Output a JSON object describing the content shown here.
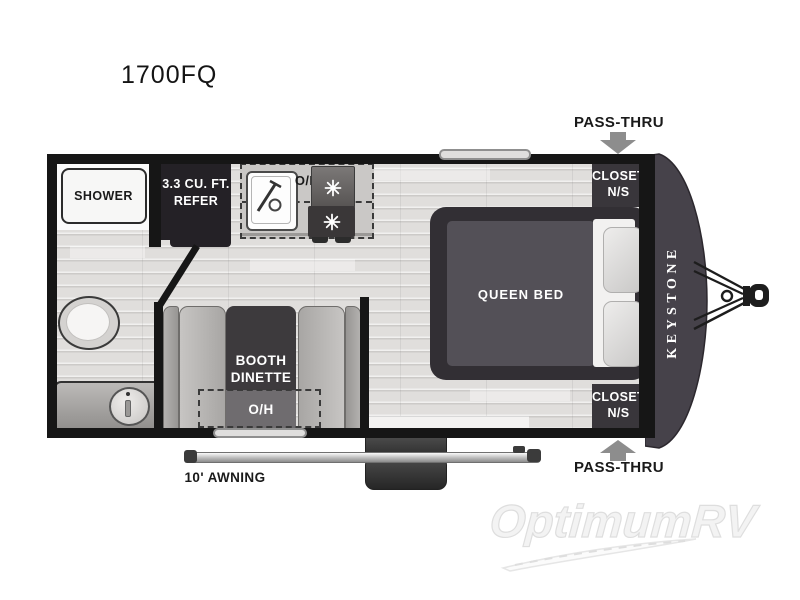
{
  "page": {
    "title": "1700FQ",
    "watermark": "OptimumRV"
  },
  "exterior": {
    "pass_thru_top": "PASS-THRU",
    "pass_thru_bottom": "PASS-THRU",
    "awning": "10' AWNING",
    "brand": "KEYSTONE"
  },
  "rooms": {
    "shower": "SHOWER",
    "refrigerator": {
      "line1": "3.3 CU. FT.",
      "line2": "REFER"
    },
    "kitchen": {
      "overhead": "O/H"
    },
    "bedroom": {
      "bed": "QUEEN BED"
    },
    "closet_front_top": {
      "line1": "CLOSET",
      "line2": "N/S"
    },
    "closet_front_bottom": {
      "line1": "CLOSET",
      "line2": "N/S"
    },
    "dinette": {
      "line1": "BOOTH",
      "line2": "DINETTE",
      "overhead": "O/H"
    }
  },
  "colors": {
    "wall": "#161616",
    "dark_fixture": "#39363b",
    "floor": "#e0dedc",
    "bench": "#bdbbb9",
    "arrow": "#8d8d8d",
    "front_cap": "#46424a"
  }
}
